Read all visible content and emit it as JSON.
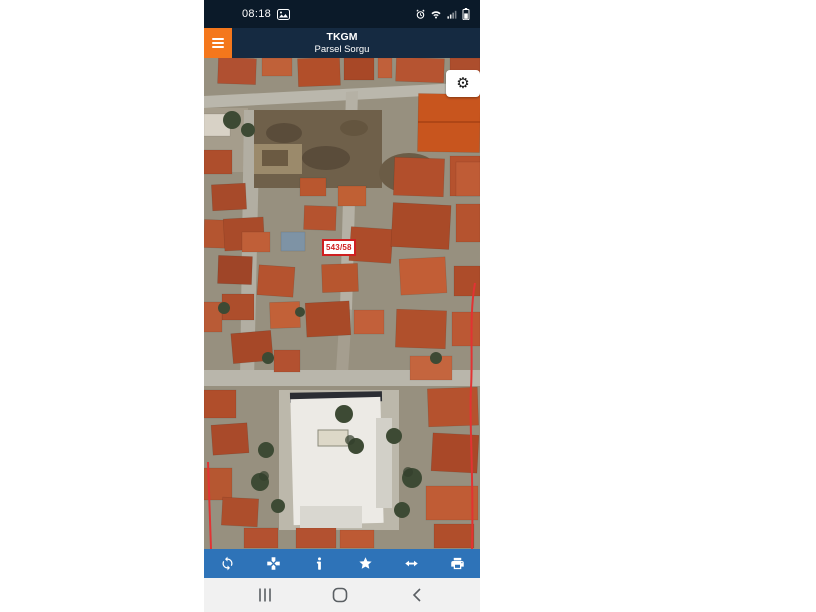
{
  "status_bar": {
    "time": "08:18",
    "left_icons": [
      "screenshot-image-icon"
    ],
    "right_icons": [
      "alarm-icon",
      "wifi-icon",
      "signal-icon",
      "battery-icon"
    ],
    "bg_color": "#0b1a29"
  },
  "app_bar": {
    "title": "TKGM",
    "subtitle": "Parsel Sorgu",
    "bg_color": "#152a41",
    "menu_button_color": "#f4771c",
    "menu_icon": "hamburger-icon"
  },
  "map": {
    "type": "satellite-imagery",
    "parcel_label": "543/58",
    "parcel_label_color": "#cf1f1f",
    "boundary_line_color": "#e23333",
    "settings_icon": "gear-icon"
  },
  "toolbar": {
    "bg_color": "#2e73b8",
    "buttons": [
      {
        "id": "refresh",
        "icon": "refresh-icon"
      },
      {
        "id": "center-location",
        "icon": "center-location-icon"
      },
      {
        "id": "info",
        "icon": "info-icon"
      },
      {
        "id": "favorite",
        "icon": "star-icon"
      },
      {
        "id": "measure",
        "icon": "double-arrow-icon"
      },
      {
        "id": "print",
        "icon": "printer-icon"
      }
    ]
  },
  "nav_bar": {
    "bg_color": "#f1f1f1",
    "buttons": [
      {
        "id": "recents",
        "icon": "recents-icon"
      },
      {
        "id": "home",
        "icon": "home-icon"
      },
      {
        "id": "back",
        "icon": "back-icon"
      }
    ]
  }
}
